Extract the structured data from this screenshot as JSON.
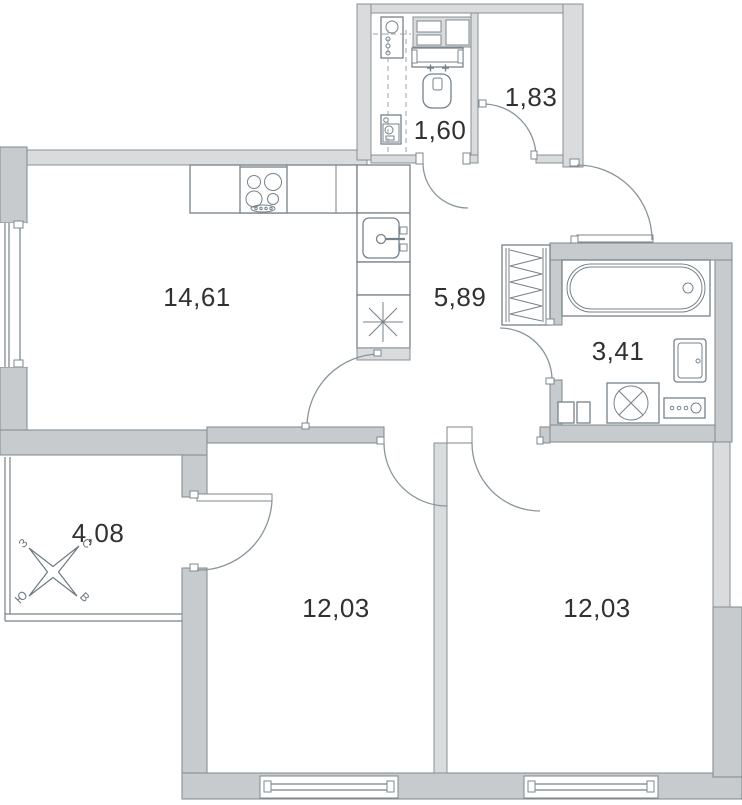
{
  "floorplan": {
    "rooms": [
      {
        "id": "kitchen-living-room",
        "area": "14,61"
      },
      {
        "id": "hallway",
        "area": "5,89"
      },
      {
        "id": "water-closet",
        "area": "1,60"
      },
      {
        "id": "entry-hall",
        "area": "1,83"
      },
      {
        "id": "bathroom",
        "area": "3,41"
      },
      {
        "id": "balcony",
        "area": "4,08"
      },
      {
        "id": "bedroom-left",
        "area": "12,03"
      },
      {
        "id": "bedroom-right",
        "area": "12,03"
      }
    ],
    "compass": {
      "north": "С",
      "east": "В",
      "south": "Ю",
      "west": "З"
    },
    "colors": {
      "wall": "#c7cbcd",
      "wall_light": "#d9dbdc",
      "line": "#7d878d",
      "arc": "#8a959b",
      "text": "#2f3133",
      "background": "#ffffff"
    }
  }
}
